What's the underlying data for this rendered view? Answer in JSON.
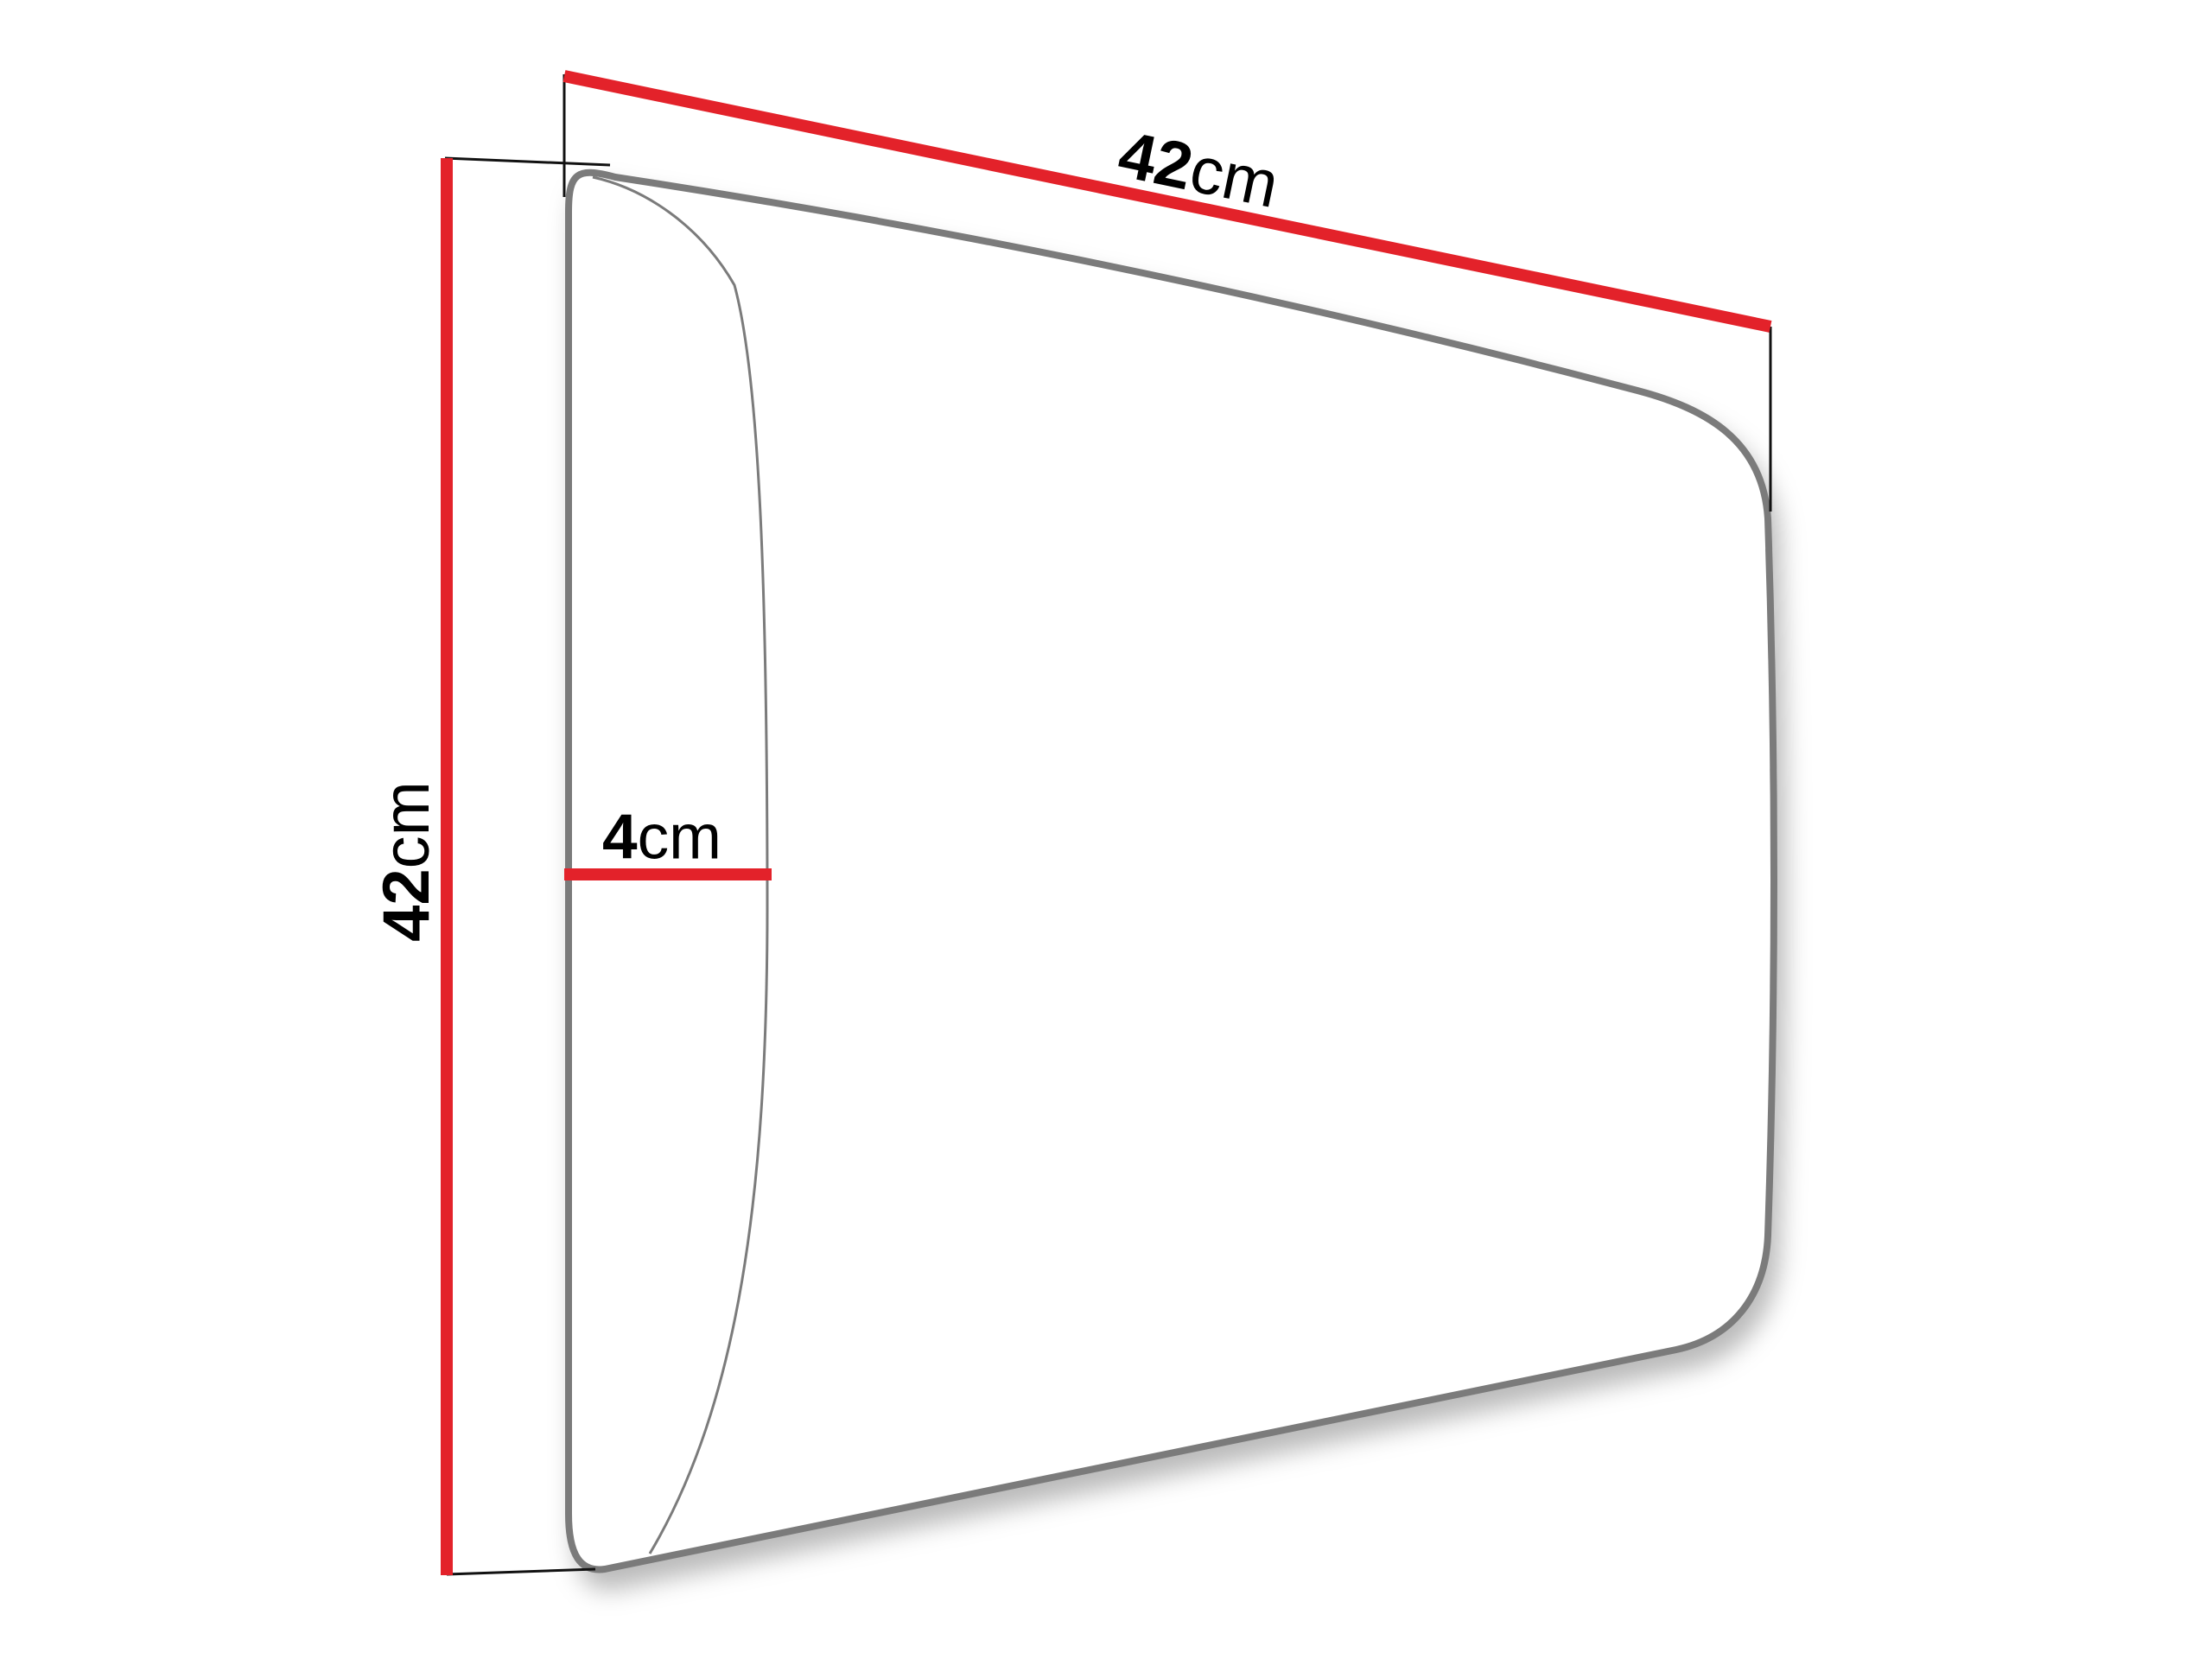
{
  "diagram": {
    "background": "#ffffff",
    "colors": {
      "dimension_line": "#e3222a",
      "outline": "#7b7b7b",
      "extension_line": "#111111",
      "panel_fill": "#ffffff",
      "text": "#000000"
    },
    "dimensions": {
      "width": {
        "value": "42",
        "unit": "cm"
      },
      "height": {
        "value": "42",
        "unit": "cm"
      },
      "thickness": {
        "value": "4",
        "unit": "cm"
      }
    }
  }
}
